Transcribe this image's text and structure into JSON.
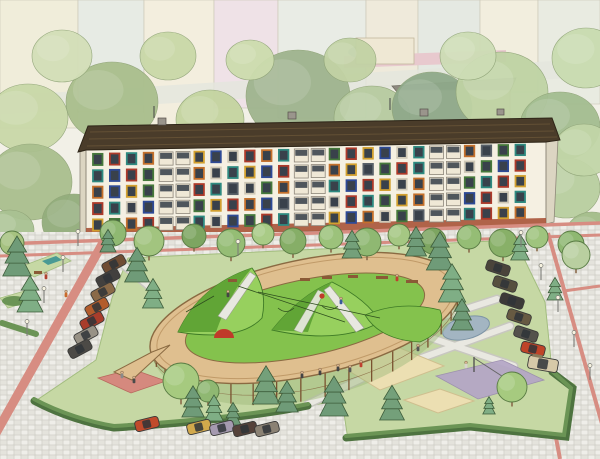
{
  "meta": {
    "title": "Courtyard playground illustration",
    "width": 600,
    "height": 459
  },
  "palette": {
    "bg": "#f2f0e7",
    "band": "#e3e6dd",
    "roof": "#4a3c2a",
    "roof_line": "#635035",
    "wall": "#f5f0e2",
    "wall_side": "#dcd5c2",
    "brick": "#a85339",
    "glass": "#39414b",
    "balcony": "#efe8d6",
    "balcony_edge": "#8d867a",
    "cobble_a": "#e4e3dc",
    "cobble_b": "#d7d6cf",
    "cobble_c": "#efeee9",
    "pink": "#d78d82",
    "pink_edge": "#b8695e",
    "lawn": "#c6d8a4",
    "lawn_edge": "#a3bd7f",
    "hedge": "#6b9455",
    "hedge_dark": "#4e7340",
    "wood_deck": "#dfbf8f",
    "wood_edge": "#8a6a42",
    "wood_rail": "#c09a68",
    "wood_post": "#7a5230",
    "skirt": "#9cb878",
    "hill": "#84c24d",
    "hill_light": "#97d05e",
    "hill_dark": "#61a536",
    "hill_line": "#3e7a26",
    "sand": "#ecdfb2",
    "sand_edge": "#cfbf8f",
    "pond": "#a3b5c2",
    "pond_edge": "#7e95a6",
    "court": "#b4a6c6",
    "red": "#c03a2a",
    "red_area": "#d5897e",
    "path": "#e9e8e1",
    "path_edge": "#c8c7c0",
    "tree_outline": "#587b43",
    "conifer_outline": "#3d5c3a",
    "trunk": "#8a6a4a",
    "lamp": "#7d7d78",
    "lamp_glow": "#f7f3e0"
  },
  "building": {
    "floors": 5,
    "columns": 26,
    "window_palette": {
      "r": "#ad3a2a",
      "o": "#c4702b",
      "y": "#d2a02f",
      "g": "#46793b",
      "t": "#2e8a80",
      "b": "#2e4a96",
      "p": "#6c4d9b",
      "n": "#586068",
      "w": "#cfc8b6"
    },
    "grid": [
      "grtoBBybwrotBBgrybwtBBongt",
      "tbrgBBowtybrBBoyngrtBBwgbr",
      "obygBBrtnwgoBBtbrywoBBgtry",
      "rtwbBBgyrobnBBwrtgyoBBbrwt",
      "ygorBBtwbgrtBBybowgnBBtryo"
    ]
  },
  "background": {
    "blocks": [
      {
        "x": 0,
        "y": 0,
        "w": 78,
        "h": 128,
        "c": "#f0edda"
      },
      {
        "x": 78,
        "y": 0,
        "w": 66,
        "h": 112,
        "c": "#e7ebe4"
      },
      {
        "x": 144,
        "y": 0,
        "w": 70,
        "h": 126,
        "c": "#f4eede"
      },
      {
        "x": 214,
        "y": 0,
        "w": 64,
        "h": 108,
        "c": "#efe2e7"
      },
      {
        "x": 278,
        "y": 0,
        "w": 88,
        "h": 118,
        "c": "#e9ece5"
      },
      {
        "x": 366,
        "y": 0,
        "w": 52,
        "h": 86,
        "c": "#efeadb"
      },
      {
        "x": 418,
        "y": 0,
        "w": 62,
        "h": 84,
        "c": "#e5e9e2"
      },
      {
        "x": 480,
        "y": 0,
        "w": 58,
        "h": 92,
        "c": "#f2eede"
      },
      {
        "x": 538,
        "y": 0,
        "w": 62,
        "h": 104,
        "c": "#e9ebe1"
      }
    ],
    "blobs": [
      {
        "x": 28,
        "y": 118,
        "rx": 40,
        "ry": 34,
        "c": "#c9d8a8"
      },
      {
        "x": 112,
        "y": 102,
        "rx": 46,
        "ry": 40,
        "c": "#a9be8c"
      },
      {
        "x": 210,
        "y": 120,
        "rx": 34,
        "ry": 30,
        "c": "#c4d4a0"
      },
      {
        "x": 298,
        "y": 96,
        "rx": 52,
        "ry": 46,
        "c": "#9fb48e"
      },
      {
        "x": 372,
        "y": 118,
        "rx": 38,
        "ry": 32,
        "c": "#b7cba0"
      },
      {
        "x": 432,
        "y": 108,
        "rx": 40,
        "ry": 36,
        "c": "#8fa98a"
      },
      {
        "x": 502,
        "y": 92,
        "rx": 46,
        "ry": 40,
        "c": "#bfd3a4"
      },
      {
        "x": 560,
        "y": 126,
        "rx": 40,
        "ry": 34,
        "c": "#a3bd90"
      },
      {
        "x": 586,
        "y": 58,
        "rx": 34,
        "ry": 30,
        "c": "#c9dcb0"
      },
      {
        "x": 62,
        "y": 56,
        "rx": 30,
        "ry": 26,
        "c": "#d3dfb8"
      },
      {
        "x": 168,
        "y": 56,
        "rx": 28,
        "ry": 24,
        "c": "#c9d8a8"
      },
      {
        "x": 468,
        "y": 56,
        "rx": 28,
        "ry": 24,
        "c": "#cdddb5"
      },
      {
        "x": 350,
        "y": 60,
        "rx": 26,
        "ry": 22,
        "c": "#c2d2a4"
      },
      {
        "x": 250,
        "y": 60,
        "rx": 24,
        "ry": 20,
        "c": "#cddcae"
      },
      {
        "x": 30,
        "y": 182,
        "rx": 42,
        "ry": 38,
        "c": "#aabf8e"
      },
      {
        "x": 74,
        "y": 222,
        "rx": 32,
        "ry": 28,
        "c": "#93ad7c"
      },
      {
        "x": 10,
        "y": 230,
        "rx": 24,
        "ry": 20,
        "c": "#a9c292"
      },
      {
        "x": 566,
        "y": 188,
        "rx": 34,
        "ry": 30,
        "c": "#b9cfa0"
      },
      {
        "x": 592,
        "y": 234,
        "rx": 26,
        "ry": 22,
        "c": "#a3bd8a"
      },
      {
        "x": 584,
        "y": 150,
        "rx": 30,
        "ry": 26,
        "c": "#c2d6a8"
      }
    ]
  },
  "trees": [
    {
      "x": 113,
      "y": 233,
      "r": 13,
      "c": "#8fb872"
    },
    {
      "x": 149,
      "y": 241,
      "r": 15,
      "c": "#a2c47f"
    },
    {
      "x": 194,
      "y": 236,
      "r": 12,
      "c": "#7da561"
    },
    {
      "x": 231,
      "y": 243,
      "r": 14,
      "c": "#95bd75"
    },
    {
      "x": 263,
      "y": 234,
      "r": 11,
      "c": "#a9cb86"
    },
    {
      "x": 293,
      "y": 241,
      "r": 13,
      "c": "#86ae67"
    },
    {
      "x": 331,
      "y": 237,
      "r": 12,
      "c": "#9cc27b"
    },
    {
      "x": 367,
      "y": 242,
      "r": 14,
      "c": "#8fb872"
    },
    {
      "x": 399,
      "y": 235,
      "r": 11,
      "c": "#a5c783"
    },
    {
      "x": 433,
      "y": 241,
      "r": 13,
      "c": "#7da561"
    },
    {
      "x": 469,
      "y": 237,
      "r": 12,
      "c": "#95bd75"
    },
    {
      "x": 503,
      "y": 243,
      "r": 14,
      "c": "#88b068"
    },
    {
      "x": 537,
      "y": 237,
      "r": 11,
      "c": "#9fc47e"
    },
    {
      "x": 571,
      "y": 244,
      "r": 13,
      "c": "#8fb872"
    },
    {
      "x": 181,
      "y": 381,
      "r": 18,
      "c": "#a6ca7f"
    },
    {
      "x": 208,
      "y": 391,
      "r": 11,
      "c": "#8fb872"
    },
    {
      "x": 512,
      "y": 387,
      "r": 15,
      "c": "#a6ca7f"
    },
    {
      "x": 576,
      "y": 255,
      "r": 14,
      "c": "#b9cfa0"
    },
    {
      "x": 12,
      "y": 243,
      "r": 12,
      "c": "#a6c280"
    }
  ],
  "conifers": [
    {
      "x": 17,
      "y": 276,
      "h": 46,
      "c": "#6f9b78"
    },
    {
      "x": 30,
      "y": 312,
      "h": 42,
      "c": "#7fae85"
    },
    {
      "x": 137,
      "y": 282,
      "h": 40,
      "c": "#6f9b78"
    },
    {
      "x": 153,
      "y": 308,
      "h": 34,
      "c": "#7fae85"
    },
    {
      "x": 108,
      "y": 252,
      "h": 26,
      "c": "#6f9b78"
    },
    {
      "x": 352,
      "y": 258,
      "h": 32,
      "c": "#74a07a"
    },
    {
      "x": 416,
      "y": 256,
      "h": 34,
      "c": "#6f9b78"
    },
    {
      "x": 520,
      "y": 260,
      "h": 30,
      "c": "#7fae85"
    },
    {
      "x": 440,
      "y": 270,
      "h": 44,
      "c": "#6f9b78"
    },
    {
      "x": 452,
      "y": 302,
      "h": 44,
      "c": "#7fae85"
    },
    {
      "x": 462,
      "y": 330,
      "h": 36,
      "c": "#6f9b78"
    },
    {
      "x": 193,
      "y": 417,
      "h": 36,
      "c": "#6f9b78"
    },
    {
      "x": 214,
      "y": 421,
      "h": 30,
      "c": "#7fae85"
    },
    {
      "x": 233,
      "y": 425,
      "h": 26,
      "c": "#6f9b78"
    },
    {
      "x": 266,
      "y": 404,
      "h": 44,
      "c": "#74a07a"
    },
    {
      "x": 287,
      "y": 412,
      "h": 36,
      "c": "#6f9b78"
    },
    {
      "x": 334,
      "y": 416,
      "h": 46,
      "c": "#6f9b78"
    },
    {
      "x": 392,
      "y": 420,
      "h": 40,
      "c": "#74a07a"
    },
    {
      "x": 489,
      "y": 414,
      "h": 20,
      "c": "#7fae85"
    },
    {
      "x": 555,
      "y": 300,
      "h": 26,
      "c": "#7fae85"
    }
  ],
  "cars": [
    {
      "x": 114,
      "y": 264,
      "rot": -28,
      "c": "#6f4c33"
    },
    {
      "x": 108,
      "y": 278,
      "rot": -28,
      "c": "#42403e"
    },
    {
      "x": 103,
      "y": 292,
      "rot": -28,
      "c": "#8a6a48"
    },
    {
      "x": 97,
      "y": 307,
      "rot": -28,
      "c": "#b35c2c"
    },
    {
      "x": 92,
      "y": 321,
      "rot": -28,
      "c": "#a93d2b"
    },
    {
      "x": 86,
      "y": 335,
      "rot": -28,
      "c": "#989286"
    },
    {
      "x": 80,
      "y": 349,
      "rot": -28,
      "c": "#4c4a46"
    },
    {
      "x": 147,
      "y": 424,
      "rot": -14,
      "c": "#c14b2c"
    },
    {
      "x": 199,
      "y": 427,
      "rot": -14,
      "c": "#d2a94c"
    },
    {
      "x": 222,
      "y": 428,
      "rot": -14,
      "c": "#a59ab0"
    },
    {
      "x": 245,
      "y": 429,
      "rot": -14,
      "c": "#55423a"
    },
    {
      "x": 267,
      "y": 429,
      "rot": -14,
      "c": "#8b8274"
    },
    {
      "x": 498,
      "y": 268,
      "rot": 18,
      "c": "#4a443b"
    },
    {
      "x": 505,
      "y": 284,
      "rot": 18,
      "c": "#56503e"
    },
    {
      "x": 512,
      "y": 301,
      "rot": 18,
      "c": "#3c3a38"
    },
    {
      "x": 519,
      "y": 317,
      "rot": 18,
      "c": "#675a42"
    },
    {
      "x": 526,
      "y": 334,
      "rot": 18,
      "c": "#54524c"
    },
    {
      "x": 533,
      "y": 349,
      "rot": 14,
      "c": "#bf4428"
    },
    {
      "x": 543,
      "y": 364,
      "rot": 10,
      "c": "#d6c9a8",
      "van": true
    }
  ],
  "lamps": [
    [
      78,
      246
    ],
    [
      63,
      272
    ],
    [
      44,
      303
    ],
    [
      27,
      336
    ],
    [
      521,
      247
    ],
    [
      541,
      280
    ],
    [
      558,
      312
    ],
    [
      574,
      347
    ],
    [
      590,
      380
    ],
    [
      238,
      256
    ]
  ],
  "people": [
    {
      "x": 66,
      "y": 296,
      "c": "#c96a2b"
    },
    {
      "x": 46,
      "y": 278,
      "c": "#b04030"
    },
    {
      "x": 122,
      "y": 377,
      "c": "#8a8a8a"
    },
    {
      "x": 134,
      "y": 382,
      "c": "#4a4a4a"
    },
    {
      "x": 302,
      "y": 377,
      "c": "#444444"
    },
    {
      "x": 320,
      "y": 374,
      "c": "#444444"
    },
    {
      "x": 338,
      "y": 370,
      "c": "#444444"
    },
    {
      "x": 361,
      "y": 366,
      "c": "#bf4030"
    },
    {
      "x": 350,
      "y": 371,
      "c": "#555555"
    },
    {
      "x": 466,
      "y": 367,
      "c": "#d8d4cc"
    },
    {
      "x": 397,
      "y": 280,
      "c": "#bf4030"
    },
    {
      "x": 228,
      "y": 296,
      "c": "#444444"
    },
    {
      "x": 341,
      "y": 303,
      "c": "#3a5a9a"
    },
    {
      "x": 418,
      "y": 350,
      "c": "#555555"
    }
  ],
  "ring": {
    "cx": 305,
    "cy": 318,
    "rx": 158,
    "ry": 58,
    "rot": -12,
    "inner_rx": 122,
    "inner_ry": 38,
    "fence_depth": 24
  }
}
